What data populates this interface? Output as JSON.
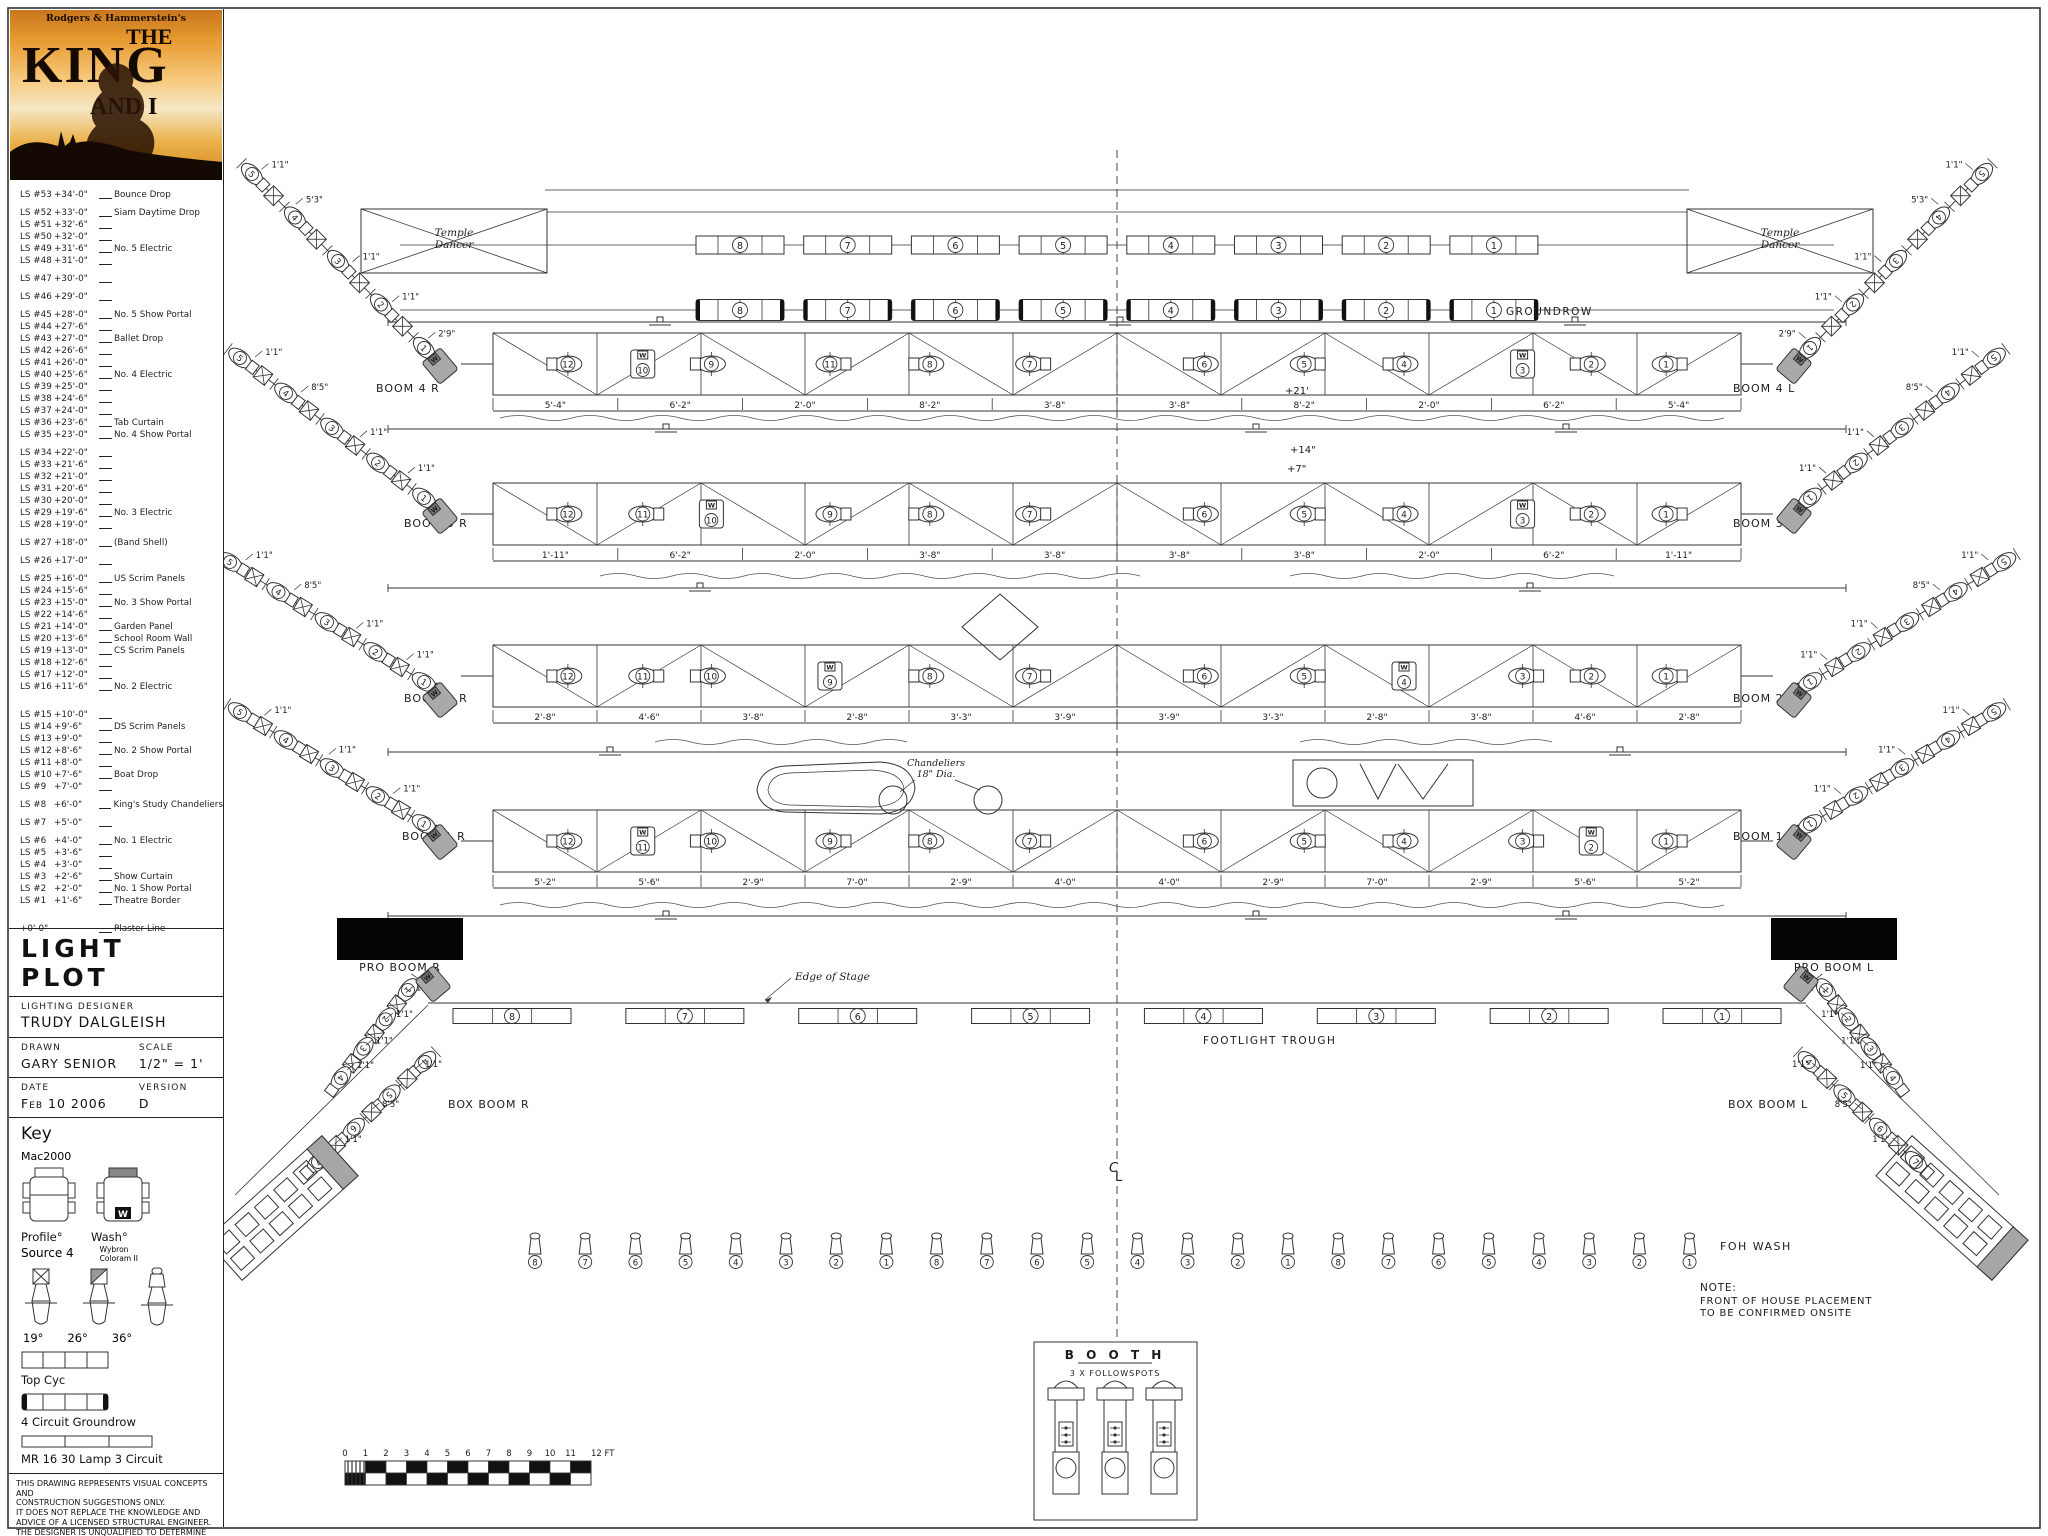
{
  "poster": {
    "credit": "Rodgers & Hammerstein's",
    "the": "THE",
    "king": "KING",
    "and_i": "AND I"
  },
  "linesets": [
    {
      "ls": "LS #53",
      "h": "+34'-0\"",
      "note": "Bounce Drop",
      "g": 0
    },
    {
      "ls": "LS #52",
      "h": "+33'-0\"",
      "note": "Siam Daytime Drop",
      "g": 1
    },
    {
      "ls": "LS #51",
      "h": "+32'-6\"",
      "note": ""
    },
    {
      "ls": "LS #50",
      "h": "+32'-0\"",
      "note": ""
    },
    {
      "ls": "LS #49",
      "h": "+31'-6\"",
      "note": "No. 5 Electric"
    },
    {
      "ls": "LS #48",
      "h": "+31'-0\"",
      "note": ""
    },
    {
      "ls": "LS #47",
      "h": "+30'-0\"",
      "note": "",
      "g": 1
    },
    {
      "ls": "LS #46",
      "h": "+29'-0\"",
      "note": "",
      "g": 1
    },
    {
      "ls": "LS #45",
      "h": "+28'-0\"",
      "note": "No. 5 Show Portal",
      "g": 1
    },
    {
      "ls": "LS #44",
      "h": "+27'-6\"",
      "note": ""
    },
    {
      "ls": "LS #43",
      "h": "+27'-0\"",
      "note": "Ballet Drop"
    },
    {
      "ls": "LS #42",
      "h": "+26'-6\"",
      "note": ""
    },
    {
      "ls": "LS #41",
      "h": "+26'-0\"",
      "note": ""
    },
    {
      "ls": "LS #40",
      "h": "+25'-6\"",
      "note": "No. 4 Electric"
    },
    {
      "ls": "LS #39",
      "h": "+25'-0\"",
      "note": ""
    },
    {
      "ls": "LS #38",
      "h": "+24'-6\"",
      "note": ""
    },
    {
      "ls": "LS #37",
      "h": "+24'-0\"",
      "note": ""
    },
    {
      "ls": "LS #36",
      "h": "+23'-6\"",
      "note": "Tab Curtain"
    },
    {
      "ls": "LS #35",
      "h": "+23'-0\"",
      "note": "No. 4 Show Portal"
    },
    {
      "ls": "LS #34",
      "h": "+22'-0\"",
      "note": "",
      "g": 1
    },
    {
      "ls": "LS #33",
      "h": "+21'-6\"",
      "note": ""
    },
    {
      "ls": "LS #32",
      "h": "+21'-0\"",
      "note": ""
    },
    {
      "ls": "LS #31",
      "h": "+20'-6\"",
      "note": ""
    },
    {
      "ls": "LS #30",
      "h": "+20'-0\"",
      "note": ""
    },
    {
      "ls": "LS #29",
      "h": "+19'-6\"",
      "note": "No. 3 Electric"
    },
    {
      "ls": "LS #28",
      "h": "+19'-0\"",
      "note": ""
    },
    {
      "ls": "LS #27",
      "h": "+18'-0\"",
      "note": "(Band Shell)",
      "g": 1
    },
    {
      "ls": "LS #26",
      "h": "+17'-0\"",
      "note": "",
      "g": 1
    },
    {
      "ls": "LS #25",
      "h": "+16'-0\"",
      "note": "US Scrim Panels",
      "g": 1
    },
    {
      "ls": "LS #24",
      "h": "+15'-6\"",
      "note": ""
    },
    {
      "ls": "LS #23",
      "h": "+15'-0\"",
      "note": "No. 3 Show Portal"
    },
    {
      "ls": "LS #22",
      "h": "+14'-6\"",
      "note": ""
    },
    {
      "ls": "LS #21",
      "h": "+14'-0\"",
      "note": "Garden Panel"
    },
    {
      "ls": "LS #20",
      "h": "+13'-6\"",
      "note": "School Room Wall"
    },
    {
      "ls": "LS #19",
      "h": "+13'-0\"",
      "note": "CS Scrim Panels"
    },
    {
      "ls": "LS #18",
      "h": "+12'-6\"",
      "note": ""
    },
    {
      "ls": "LS #17",
      "h": "+12'-0\"",
      "note": ""
    },
    {
      "ls": "LS #16",
      "h": "+11'-6\"",
      "note": "No. 2 Electric"
    },
    {
      "ls": "LS #15",
      "h": "+10'-0\"",
      "note": "",
      "g": 2
    },
    {
      "ls": "LS #14",
      "h": "+9'-6\"",
      "note": "DS Scrim Panels"
    },
    {
      "ls": "LS #13",
      "h": "+9'-0\"",
      "note": ""
    },
    {
      "ls": "LS #12",
      "h": "+8'-6\"",
      "note": "No. 2 Show Portal"
    },
    {
      "ls": "LS #11",
      "h": "+8'-0\"",
      "note": ""
    },
    {
      "ls": "LS #10",
      "h": "+7'-6\"",
      "note": "Boat Drop"
    },
    {
      "ls": "LS #9",
      "h": "+7'-0\"",
      "note": ""
    },
    {
      "ls": "LS #8",
      "h": "+6'-0\"",
      "note": "King's Study Chandeliers",
      "g": 1
    },
    {
      "ls": "LS #7",
      "h": "+5'-0\"",
      "note": "",
      "g": 1
    },
    {
      "ls": "LS #6",
      "h": "+4'-0\"",
      "note": "No. 1 Electric",
      "g": 1
    },
    {
      "ls": "LS #5",
      "h": "+3'-6\"",
      "note": ""
    },
    {
      "ls": "LS #4",
      "h": "+3'-0\"",
      "note": ""
    },
    {
      "ls": "LS #3",
      "h": "+2'-6\"",
      "note": "Show Curtain"
    },
    {
      "ls": "LS #2",
      "h": "+2'-0\"",
      "note": "No. 1 Show Portal"
    },
    {
      "ls": "LS #1",
      "h": "+1'-6\"",
      "note": "Theatre Border"
    },
    {
      "ls": "+0'-0\"",
      "h": "",
      "note": "Plaster Line",
      "g": 2
    }
  ],
  "title_block": {
    "title": "LIGHT PLOT",
    "designer_label": "Lighting Designer",
    "designer": "TRUDY DALGLEISH",
    "drawn_label": "Drawn",
    "drawn": "GARY SENIOR",
    "scale_label": "Scale",
    "scale": "1/2\" = 1'",
    "date_label": "Date",
    "date": "Feb 10 2006",
    "version_label": "Version",
    "version": "D"
  },
  "key": {
    "heading": "Key",
    "mac2000": "Mac2000",
    "profile": "Profile°",
    "wash": "Wash°",
    "wash_marker": "W",
    "source4": "Source 4",
    "wybron_1": "Wybron",
    "wybron_2": "Coloram II",
    "angles": [
      "19°",
      "26°",
      "36°"
    ],
    "top_cyc": "Top Cyc",
    "groundrow": "4 Circuit Groundrow",
    "mr16": "MR 16 30 Lamp 3 Circuit"
  },
  "disclaimer": [
    "THIS DRAWING REPRESENTS VISUAL CONCEPTS AND",
    "CONSTRUCTION SUGGESTIONS ONLY.",
    "IT DOES NOT REPLACE THE KNOWLEDGE AND",
    "ADVICE OF A LICENSED STRUCTURAL ENGINEER.",
    "THE DESIGNER IS UNQUALIFIED TO DETERMINE THE",
    "STRUCTURAL APPROPRIATENESS OF THIS DESIGN",
    "AND WILL NOT ASSUME RESPONSIBILITY FOR",
    "IMPROPER ENGINEERING OR USE."
  ],
  "drawing": {
    "temple_dancer_1": "Temple",
    "temple_dancer_2": "Dancer",
    "groundrow_label": "GROUNDROW",
    "edge_of_stage": "Edge of Stage",
    "footlight_label": "FOOTLIGHT TROUGH",
    "foh_wash_label": "FOH WASH",
    "booth_title": "B O O T H",
    "booth_sub": "3 X FOLLOWSPOTS",
    "note_lines": [
      "NOTE:",
      "FRONT OF HOUSE PLACEMENT",
      "TO BE CONFIRMED ONSITE"
    ],
    "cl_top": "C",
    "cl_bottom": "L",
    "chandeliers_1": "Chandeliers",
    "chandeliers_2": "18\" Dia.",
    "heights": {
      "h21": "+21'",
      "h14": "+14\"",
      "h7": "+7\""
    },
    "booms": {
      "b4r": "BOOM 4 R",
      "b3r": "BOOM 3 R",
      "b2r": "BOOM 2 R",
      "b1r": "BOOM 1 R",
      "b4l": "BOOM 4 L",
      "b3l": "BOOM 3 L",
      "b2l": "BOOM 2 L",
      "b1l": "BOOM 1 L",
      "pror": "PRO BOOM R",
      "prol": "PRO BOOM L",
      "boxr": "BOX BOOM R",
      "boxl": "BOX BOOM L"
    },
    "dims": {
      "d11": "1'1\"",
      "d53": "5'3\"",
      "d85": "8'5\"",
      "d29": "2'9\""
    },
    "trusses": [
      {
        "dims": [
          "5'-4\"",
          "6'-2\"",
          "2'-0\"",
          "8'-2\"",
          "3'-8\"",
          "3'-8\"",
          "8'-2\"",
          "2'-0\"",
          "6'-2\"",
          "5'-4\""
        ],
        "units": [
          12,
          10,
          9,
          11,
          8,
          7,
          6,
          5,
          4,
          3,
          2,
          1
        ],
        "macs": [
          1,
          9
        ]
      },
      {
        "dims": [
          "1'-11\"",
          "6'-2\"",
          "2'-0\"",
          "3'-8\"",
          "3'-8\"",
          "3'-8\"",
          "3'-8\"",
          "2'-0\"",
          "6'-2\"",
          "1'-11\""
        ],
        "units": [
          12,
          11,
          10,
          9,
          8,
          7,
          6,
          5,
          4,
          3,
          2,
          1
        ],
        "macs": [
          2,
          9
        ]
      },
      {
        "dims": [
          "2'-8\"",
          "4'-6\"",
          "3'-8\"",
          "2'-8\"",
          "3'-3\"",
          "3'-9\"",
          "3'-9\"",
          "3'-3\"",
          "2'-8\"",
          "3'-8\"",
          "4'-6\"",
          "2'-8\""
        ],
        "units": [
          12,
          11,
          10,
          9,
          8,
          7,
          6,
          5,
          4,
          3,
          2,
          1
        ],
        "macs": [
          3,
          8
        ]
      },
      {
        "dims": [
          "5'-2\"",
          "5'-6\"",
          "2'-9\"",
          "7'-0\"",
          "2'-9\"",
          "4'-0\"",
          "4'-0\"",
          "2'-9\"",
          "7'-0\"",
          "2'-9\"",
          "5'-6\"",
          "5'-2\""
        ],
        "units": [
          12,
          11,
          10,
          9,
          8,
          7,
          6,
          5,
          4,
          3,
          2,
          1
        ],
        "macs": [
          1,
          10
        ]
      }
    ],
    "cyc_strip_numbers": [
      8,
      7,
      6,
      5,
      4,
      3,
      2,
      1
    ],
    "groundrow_strip_numbers": [
      8,
      7,
      6,
      5,
      4,
      3,
      2,
      1
    ],
    "footlight_strip_numbers": [
      8,
      7,
      6,
      5,
      4,
      3,
      2,
      1
    ],
    "foh_numbers": [
      8,
      7,
      6,
      5,
      4,
      3,
      2,
      1,
      8,
      7,
      6,
      5,
      4,
      3,
      2,
      1,
      8,
      7,
      6,
      5,
      4,
      3,
      2,
      1
    ],
    "boom_unit_numbers": [
      5,
      4,
      3,
      2,
      1
    ],
    "proboom_unit_numbers": [
      1,
      2,
      3,
      4
    ],
    "boxboom_unit_numbers": [
      4,
      5,
      6,
      7
    ],
    "scale_ticks": [
      "0",
      "1",
      "2",
      "3",
      "4",
      "5",
      "6",
      "7",
      "8",
      "9",
      "10",
      "11",
      "12 FT"
    ]
  }
}
